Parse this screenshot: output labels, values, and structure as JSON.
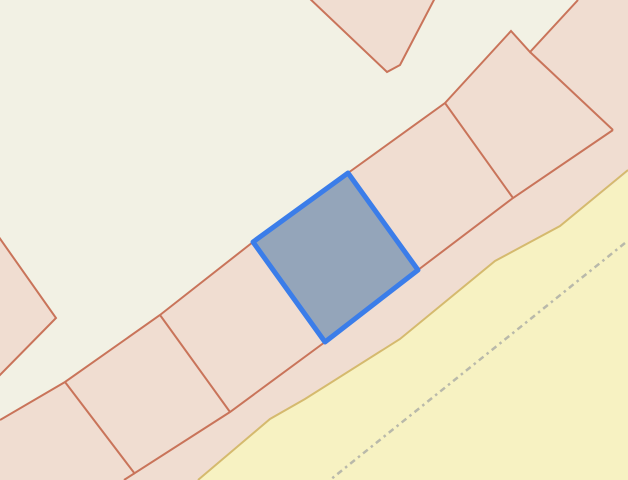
{
  "map": {
    "canvas": {
      "width": 628,
      "height": 480
    },
    "background_color": "#f2f1e4",
    "palette": {
      "background": "#f2f1e4",
      "parcel_fill": "#f0ddd1",
      "parcel_line": "#c9745a",
      "selection_stroke": "#3b7de9",
      "selection_fill": "#94a5ba",
      "road_fill": "#f7f2c2",
      "road_edge": "#d5ba6e",
      "track_dash": "#b9b9aa"
    },
    "features": [
      {
        "type": "polygon",
        "name": "landuse-band-polygon",
        "interactable": true,
        "fill": "parcel_fill",
        "points": [
          [
            0,
            420
          ],
          [
            65,
            382
          ],
          [
            160,
            315
          ],
          [
            253,
            242
          ],
          [
            348,
            173
          ],
          [
            445,
            103
          ],
          [
            511,
            31
          ],
          [
            530,
            52
          ],
          [
            578,
            0
          ],
          [
            628,
            0
          ],
          [
            628,
            172
          ],
          [
            560,
            227
          ],
          [
            495,
            262
          ],
          [
            400,
            340
          ],
          [
            305,
            400
          ],
          [
            270,
            420
          ],
          [
            198,
            480
          ],
          [
            0,
            480
          ]
        ]
      },
      {
        "type": "polygon",
        "name": "building-top-center-polygon",
        "interactable": true,
        "fill": "parcel_fill",
        "stroke": "parcel_line",
        "stroke_width": 2,
        "points": [
          [
            307,
            -4
          ],
          [
            387,
            72
          ],
          [
            400,
            65
          ],
          [
            436,
            -4
          ]
        ]
      },
      {
        "type": "polygon",
        "name": "building-left-edge-polygon",
        "interactable": true,
        "fill": "parcel_fill",
        "stroke": "parcel_line",
        "stroke_width": 2,
        "points": [
          [
            -4,
            233
          ],
          [
            56,
            318
          ],
          [
            -4,
            379
          ]
        ]
      },
      {
        "type": "polygon",
        "name": "road-area-polygon",
        "interactable": true,
        "fill": "road_fill",
        "points": [
          [
            628,
            172
          ],
          [
            560,
            227
          ],
          [
            495,
            262
          ],
          [
            400,
            340
          ],
          [
            305,
            400
          ],
          [
            270,
            420
          ],
          [
            198,
            480
          ],
          [
            628,
            480
          ]
        ]
      },
      {
        "type": "polyline",
        "name": "road-edge-line",
        "interactable": false,
        "stroke": "road_edge",
        "stroke_width": 2,
        "points": [
          [
            628,
            170
          ],
          [
            560,
            226
          ],
          [
            495,
            261
          ],
          [
            400,
            339
          ],
          [
            305,
            399
          ],
          [
            270,
            419
          ],
          [
            198,
            480
          ]
        ]
      },
      {
        "type": "polyline",
        "name": "track-dashed-line",
        "interactable": true,
        "stroke": "track_dash",
        "stroke_width": 2.5,
        "dash": "6 4 2.5 4",
        "points": [
          [
            625,
            243
          ],
          [
            330,
            480
          ]
        ]
      },
      {
        "type": "polyline",
        "name": "parcel-band-upper-boundary-line",
        "interactable": false,
        "stroke": "parcel_line",
        "stroke_width": 2,
        "points": [
          [
            0,
            420
          ],
          [
            65,
            382
          ],
          [
            160,
            315
          ],
          [
            253,
            242
          ],
          [
            348,
            173
          ],
          [
            445,
            103
          ],
          [
            511,
            31
          ],
          [
            530,
            52
          ],
          [
            578,
            0
          ]
        ]
      },
      {
        "type": "polyline",
        "name": "parcel-band-lower-boundary-line",
        "interactable": false,
        "stroke": "parcel_line",
        "stroke_width": 2,
        "points": [
          [
            124,
            480
          ],
          [
            230,
            412
          ],
          [
            325,
            342
          ],
          [
            418,
            270
          ],
          [
            513,
            198
          ],
          [
            613,
            130
          ]
        ]
      },
      {
        "type": "polyline",
        "name": "parcel-divider-line-1",
        "interactable": false,
        "stroke": "parcel_line",
        "stroke_width": 2,
        "points": [
          [
            65,
            382
          ],
          [
            135,
            474
          ]
        ]
      },
      {
        "type": "polyline",
        "name": "parcel-divider-line-2",
        "interactable": false,
        "stroke": "parcel_line",
        "stroke_width": 2,
        "points": [
          [
            160,
            315
          ],
          [
            230,
            412
          ]
        ]
      },
      {
        "type": "polyline",
        "name": "parcel-divider-line-3",
        "interactable": false,
        "stroke": "parcel_line",
        "stroke_width": 2,
        "points": [
          [
            445,
            103
          ],
          [
            513,
            198
          ]
        ]
      },
      {
        "type": "polyline",
        "name": "parcel-diamond-upper-right-edge-line",
        "interactable": false,
        "stroke": "parcel_line",
        "stroke_width": 2,
        "points": [
          [
            530,
            52
          ],
          [
            613,
            130
          ]
        ]
      },
      {
        "type": "polygon",
        "name": "selected-parcel-polygon",
        "interactable": true,
        "fill": "selection_fill",
        "stroke": "selection_stroke",
        "stroke_width": 5,
        "rounded": true,
        "points": [
          [
            348,
            173
          ],
          [
            418,
            270
          ],
          [
            325,
            342
          ],
          [
            253,
            242
          ]
        ]
      }
    ]
  }
}
